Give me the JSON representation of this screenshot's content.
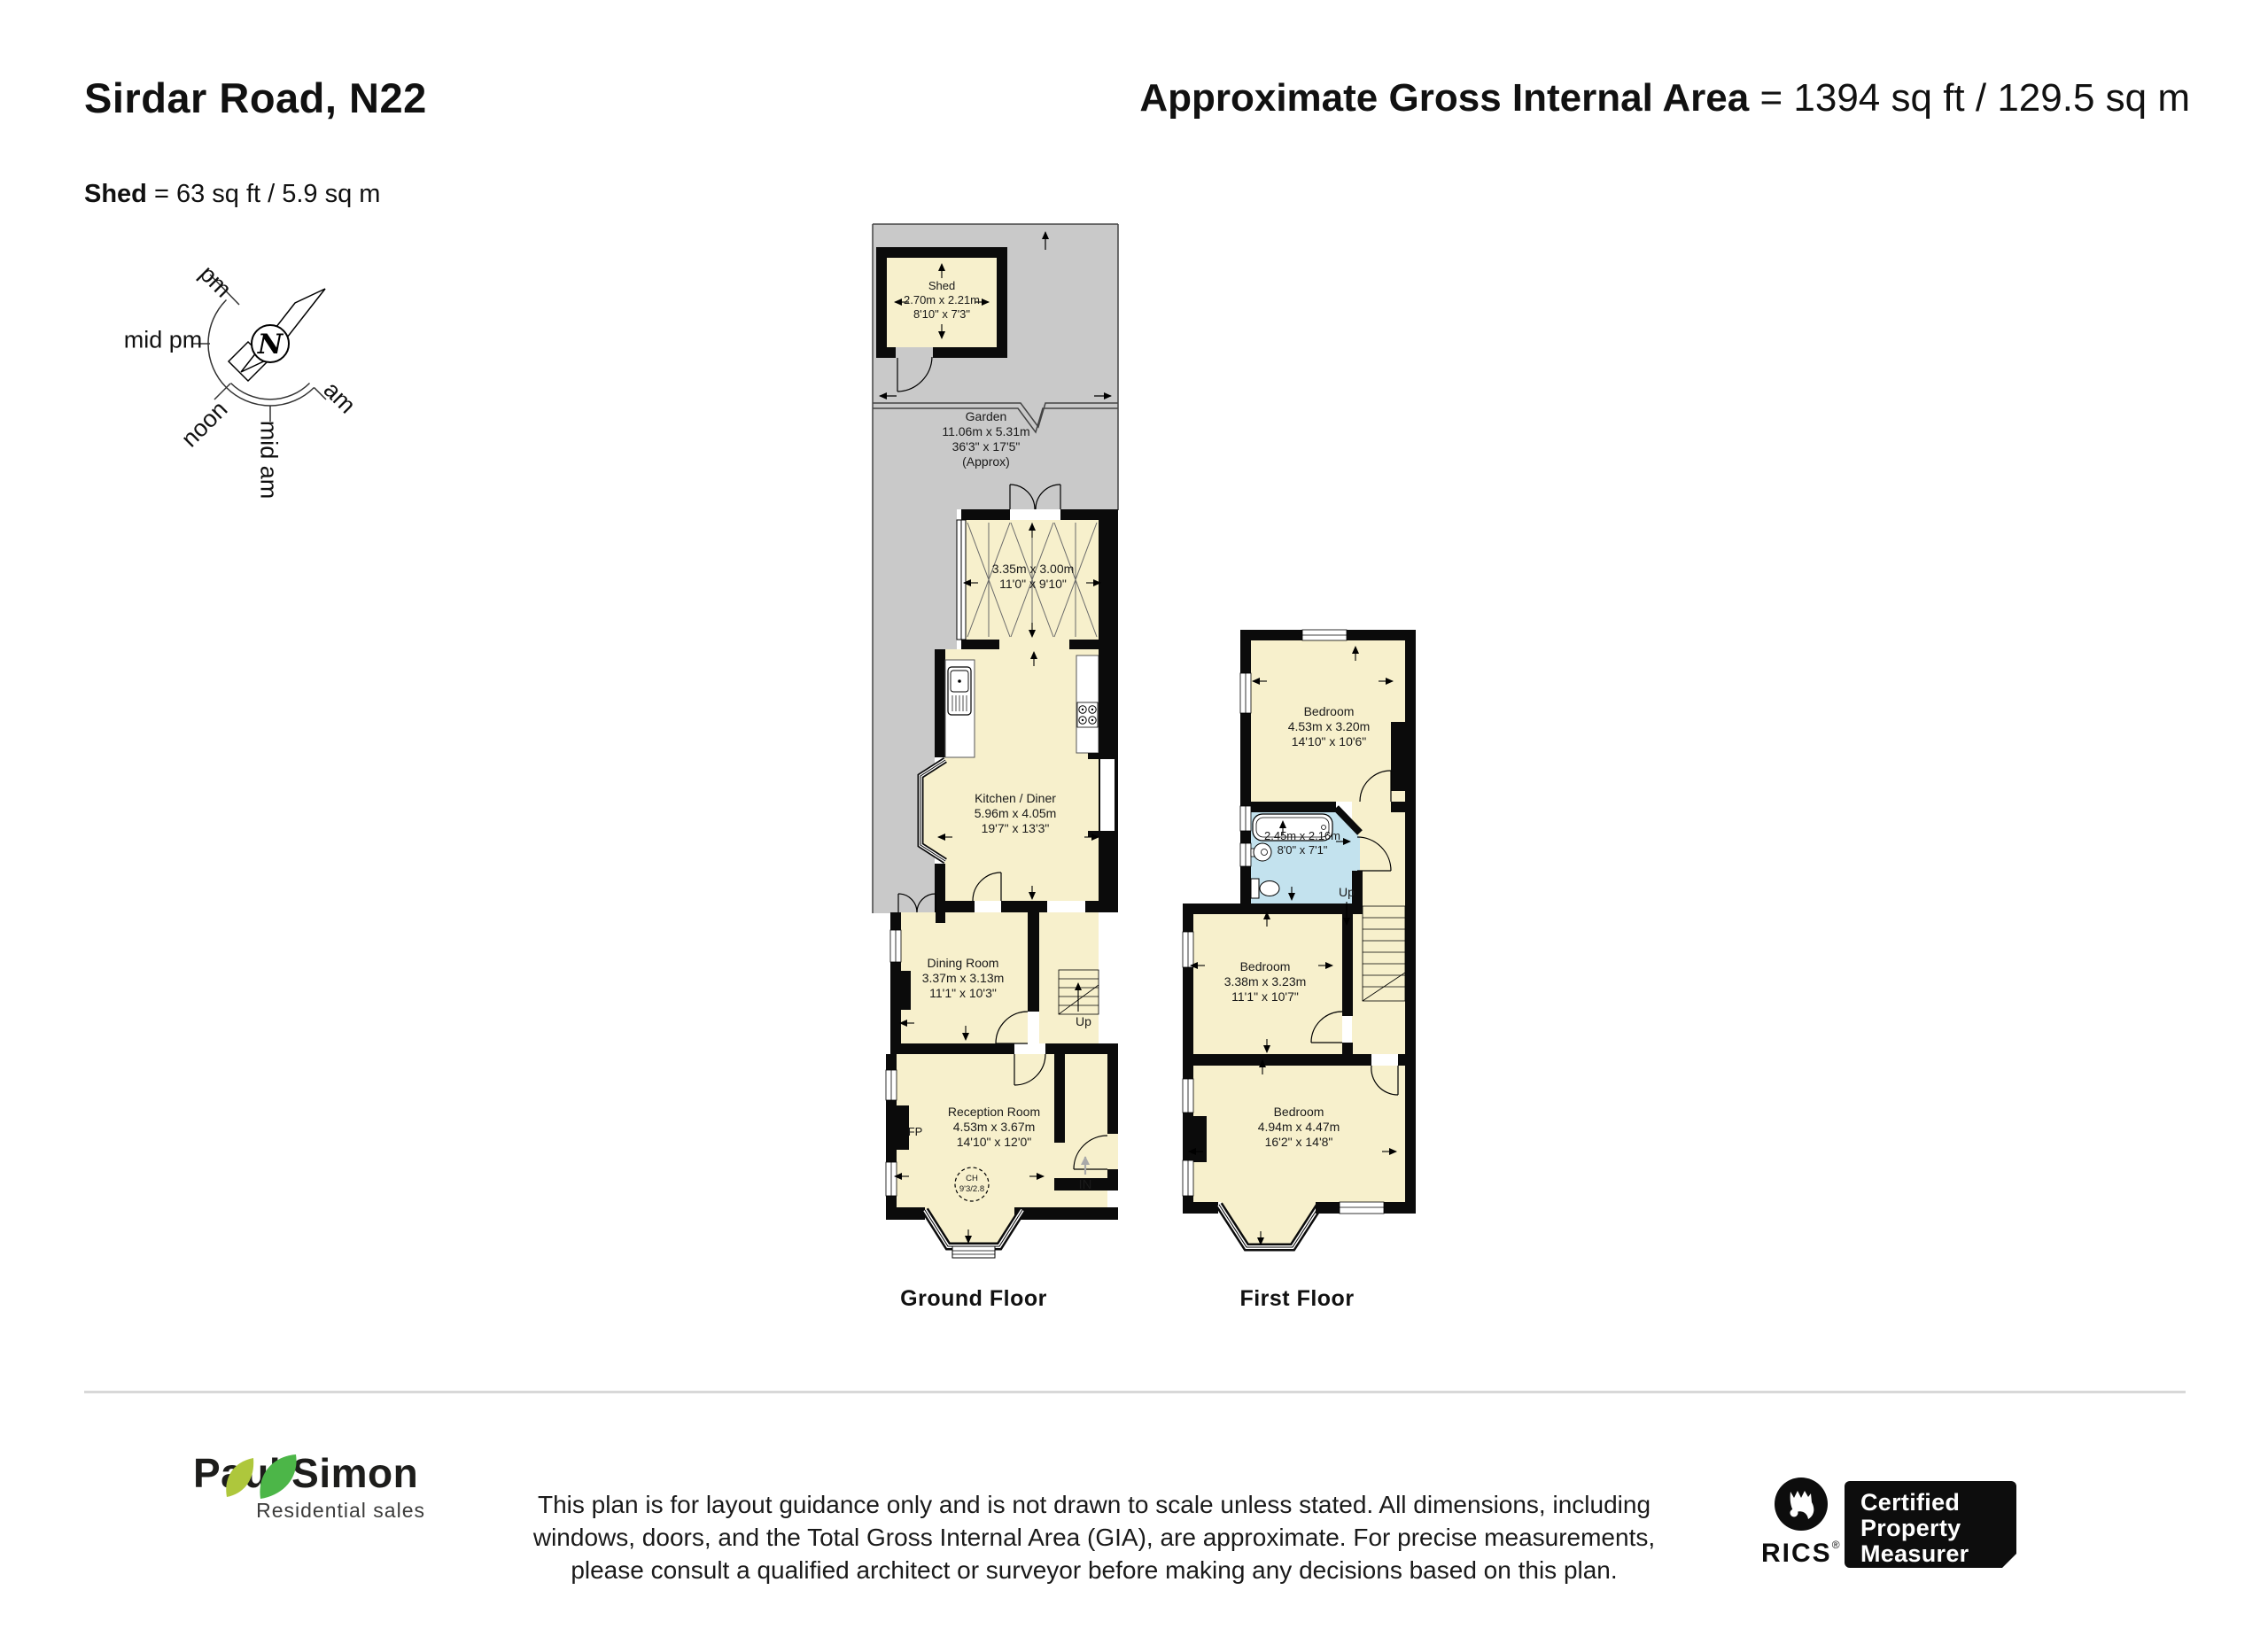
{
  "header": {
    "title": "Sirdar Road, N22",
    "gia_label": "Approximate Gross Internal Area",
    "gia_value": " = 1394 sq ft / 129.5 sq m",
    "shed_label": "Shed",
    "shed_value": " = 63 sq ft / 5.9 sq m"
  },
  "compass": {
    "north": "N",
    "labels": {
      "pm": "pm",
      "mid_pm": "mid pm",
      "noon": "noon",
      "mid_am": "mid am",
      "am": "am"
    }
  },
  "ground_floor": {
    "floor_label": "Ground Floor",
    "shed": {
      "name": "Shed",
      "dims_m": "2.70m x 2.21m",
      "dims_ft": "8'10\" x 7'3\""
    },
    "garden": {
      "name": "Garden",
      "dims_m": "11.06m x 5.31m",
      "dims_ft": "36'3\" x 17'5\"",
      "approx": "(Approx)"
    },
    "conservatory": {
      "dims_m": "3.35m x 3.00m",
      "dims_ft": "11'0\" x 9'10\""
    },
    "kitchen": {
      "name": "Kitchen / Diner",
      "dims_m": "5.96m x 4.05m",
      "dims_ft": "19'7\" x 13'3\""
    },
    "dining": {
      "name": "Dining Room",
      "dims_m": "3.37m x 3.13m",
      "dims_ft": "11'1\" x 10'3\""
    },
    "reception": {
      "name": "Reception Room",
      "dims_m": "4.53m x 3.67m",
      "dims_ft": "14'10\" x 12'0\"",
      "fireplace": "FP",
      "ch_label": "CH",
      "ch_value": "9'3/2.8"
    },
    "up_label": "Up",
    "in_label": "IN"
  },
  "first_floor": {
    "floor_label": "First Floor",
    "bedroom1": {
      "name": "Bedroom",
      "dims_m": "4.53m x 3.20m",
      "dims_ft": "14'10\" x 10'6\""
    },
    "bathroom": {
      "dims_m": "2.45m x 2.16m",
      "dims_ft": "8'0\" x 7'1\""
    },
    "bedroom2": {
      "name": "Bedroom",
      "dims_m": "3.38m x 3.23m",
      "dims_ft": "11'1\" x 10'7\""
    },
    "bedroom3": {
      "name": "Bedroom",
      "dims_m": "4.94m x 4.47m",
      "dims_ft": "16'2\" x 14'8\""
    },
    "up_label": "Up"
  },
  "footer": {
    "disclaimer_line1": "This plan is for layout guidance only and is not drawn to scale unless stated. All dimensions, including",
    "disclaimer_line2": "windows, doors, and the Total Gross Internal Area (GIA), are approximate. For precise measurements,",
    "disclaimer_line3": "please consult a qualified architect or surveyor before making any decisions based on this plan.",
    "agency": {
      "name_first": "Paul",
      "name_last": "Simon",
      "tagline": "Residential sales"
    },
    "rics": {
      "name": "RICS",
      "reg": "®",
      "cpm_line1": "Certified",
      "cpm_line2": "Property",
      "cpm_line3": "Measurer"
    }
  },
  "colors": {
    "room_fill": "#F7F0CC",
    "garden_fill": "#C9C9C9",
    "bathroom_fill": "#C3E2EE",
    "wall": "#0B0B0B"
  }
}
